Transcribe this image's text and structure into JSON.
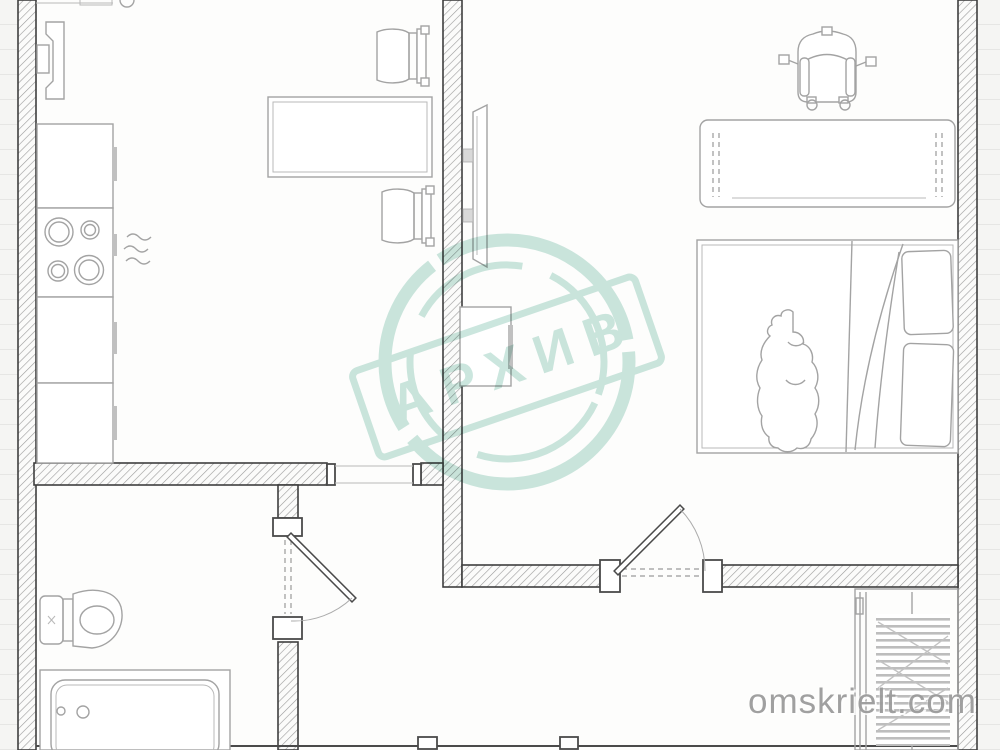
{
  "document": {
    "kind": "apartment floor plan scan",
    "paper_style": "ruled notebook paper",
    "visible_text_count": 2
  },
  "watermark": {
    "stamp_text": "АРХИВ",
    "site_text": "omskrielt.com"
  },
  "colors": {
    "mint": "#c7e4dc",
    "site_gray": "#9c9c9c",
    "wall_line": "#3f3f3f",
    "furniture_line": "#a3a3a3",
    "paper": "#f5f5f3",
    "rule_line": "#e6e6e4"
  },
  "symbols": [
    "kitchen-sink-fixture",
    "kitchen-counter",
    "stove-4-burners",
    "heat-waves",
    "desk",
    "chair",
    "wall-tv",
    "nightstand",
    "baby-stroller",
    "dresser-bench",
    "double-bed",
    "pillows",
    "person-figure",
    "toilet",
    "bathtub",
    "interior-door-swing",
    "wardrobe-rail",
    "entrance-door",
    "hatched-wall"
  ]
}
